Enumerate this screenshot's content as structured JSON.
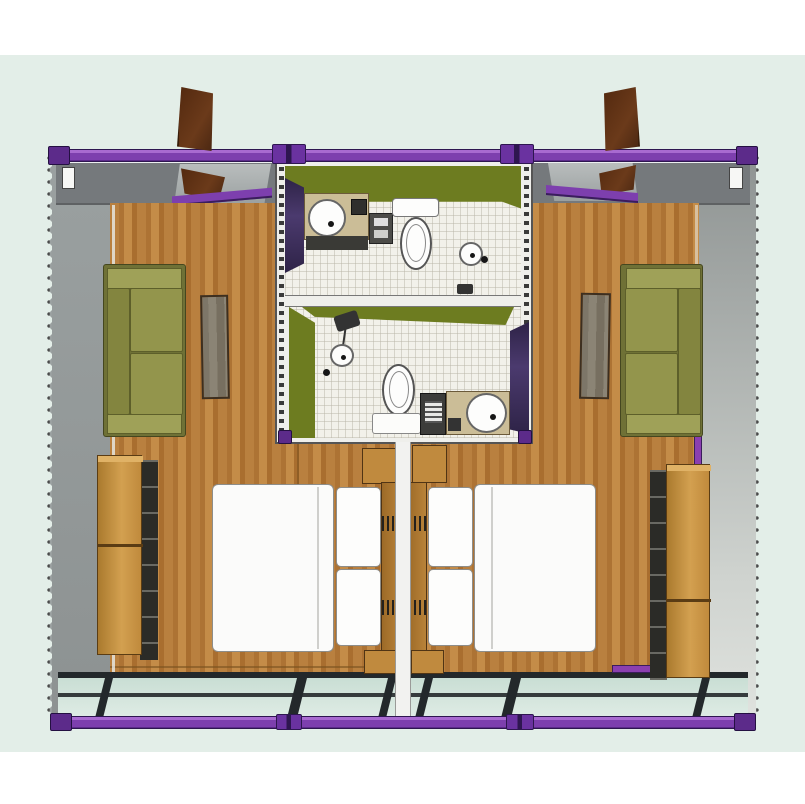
{
  "scene": {
    "kind": "3d-floor-plan-render",
    "description": "Top-down 3D rendering of a flat-pack container house: two mirrored bedroom units joined by a central module with two stacked bathrooms; purple steel frame, grey container walls, timber floors, front glazed wall.",
    "units": [
      {
        "name": "left-unit",
        "objects": [
          "entry-door-open",
          "rear-door-opening",
          "window-slit",
          "sofa",
          "rug",
          "wardrobe",
          "double-bed",
          "pillows",
          "nightstand",
          "headboard",
          "glazed-front-wall"
        ]
      },
      {
        "name": "right-unit",
        "objects": [
          "entry-door-open",
          "rear-door-opening",
          "window-slit",
          "sofa",
          "rug",
          "wardrobe",
          "double-bed",
          "pillows",
          "nightstand",
          "headboard",
          "glazed-front-wall"
        ]
      }
    ],
    "bathrooms": [
      {
        "name": "bathroom-upper",
        "fixtures": [
          "vanity-counter",
          "round-basin",
          "mirror",
          "under-counter-cabinet",
          "shelf-unit",
          "air-conditioner",
          "toilet",
          "shower-drain",
          "floor-drain"
        ]
      },
      {
        "name": "bathroom-lower",
        "fixtures": [
          "shower-head",
          "shower-drain",
          "floor-drain",
          "toilet",
          "cistern-shelf",
          "washing-machine",
          "vanity-counter",
          "round-basin"
        ]
      }
    ],
    "frame": [
      "top-beam",
      "bottom-beam",
      "corner-castings",
      "joint-connectors",
      "corrugated-side-edges"
    ]
  },
  "colors": {
    "backdrop_mint": "#e3eee8",
    "frame_purple": "#7d3fae",
    "casting_purple": "#5c2b8a",
    "accent_purple": "#8b3fb0",
    "wall_gray": "#999e9e",
    "wall_gray_dark": "#75797c",
    "wood": "#b9803f",
    "door_brown": "#6b3a1a",
    "bathroom_green": "#6d7c20",
    "tile": "#f2f1ea",
    "vanity_tan": "#cbbd97",
    "sofa_olive": "#93954c",
    "sofa_olive_dark": "#6f7136",
    "sofa_olive_light": "#9fa158",
    "rug_gray": "#847d6d",
    "wardrobe_wood": "#c8913f",
    "wardrobe_side": "#2b2b27",
    "bed_white": "#fbfbfa",
    "glass": "#c9ded4",
    "glass_frame": "#23282b",
    "divider_white": "#f2f2f0"
  }
}
